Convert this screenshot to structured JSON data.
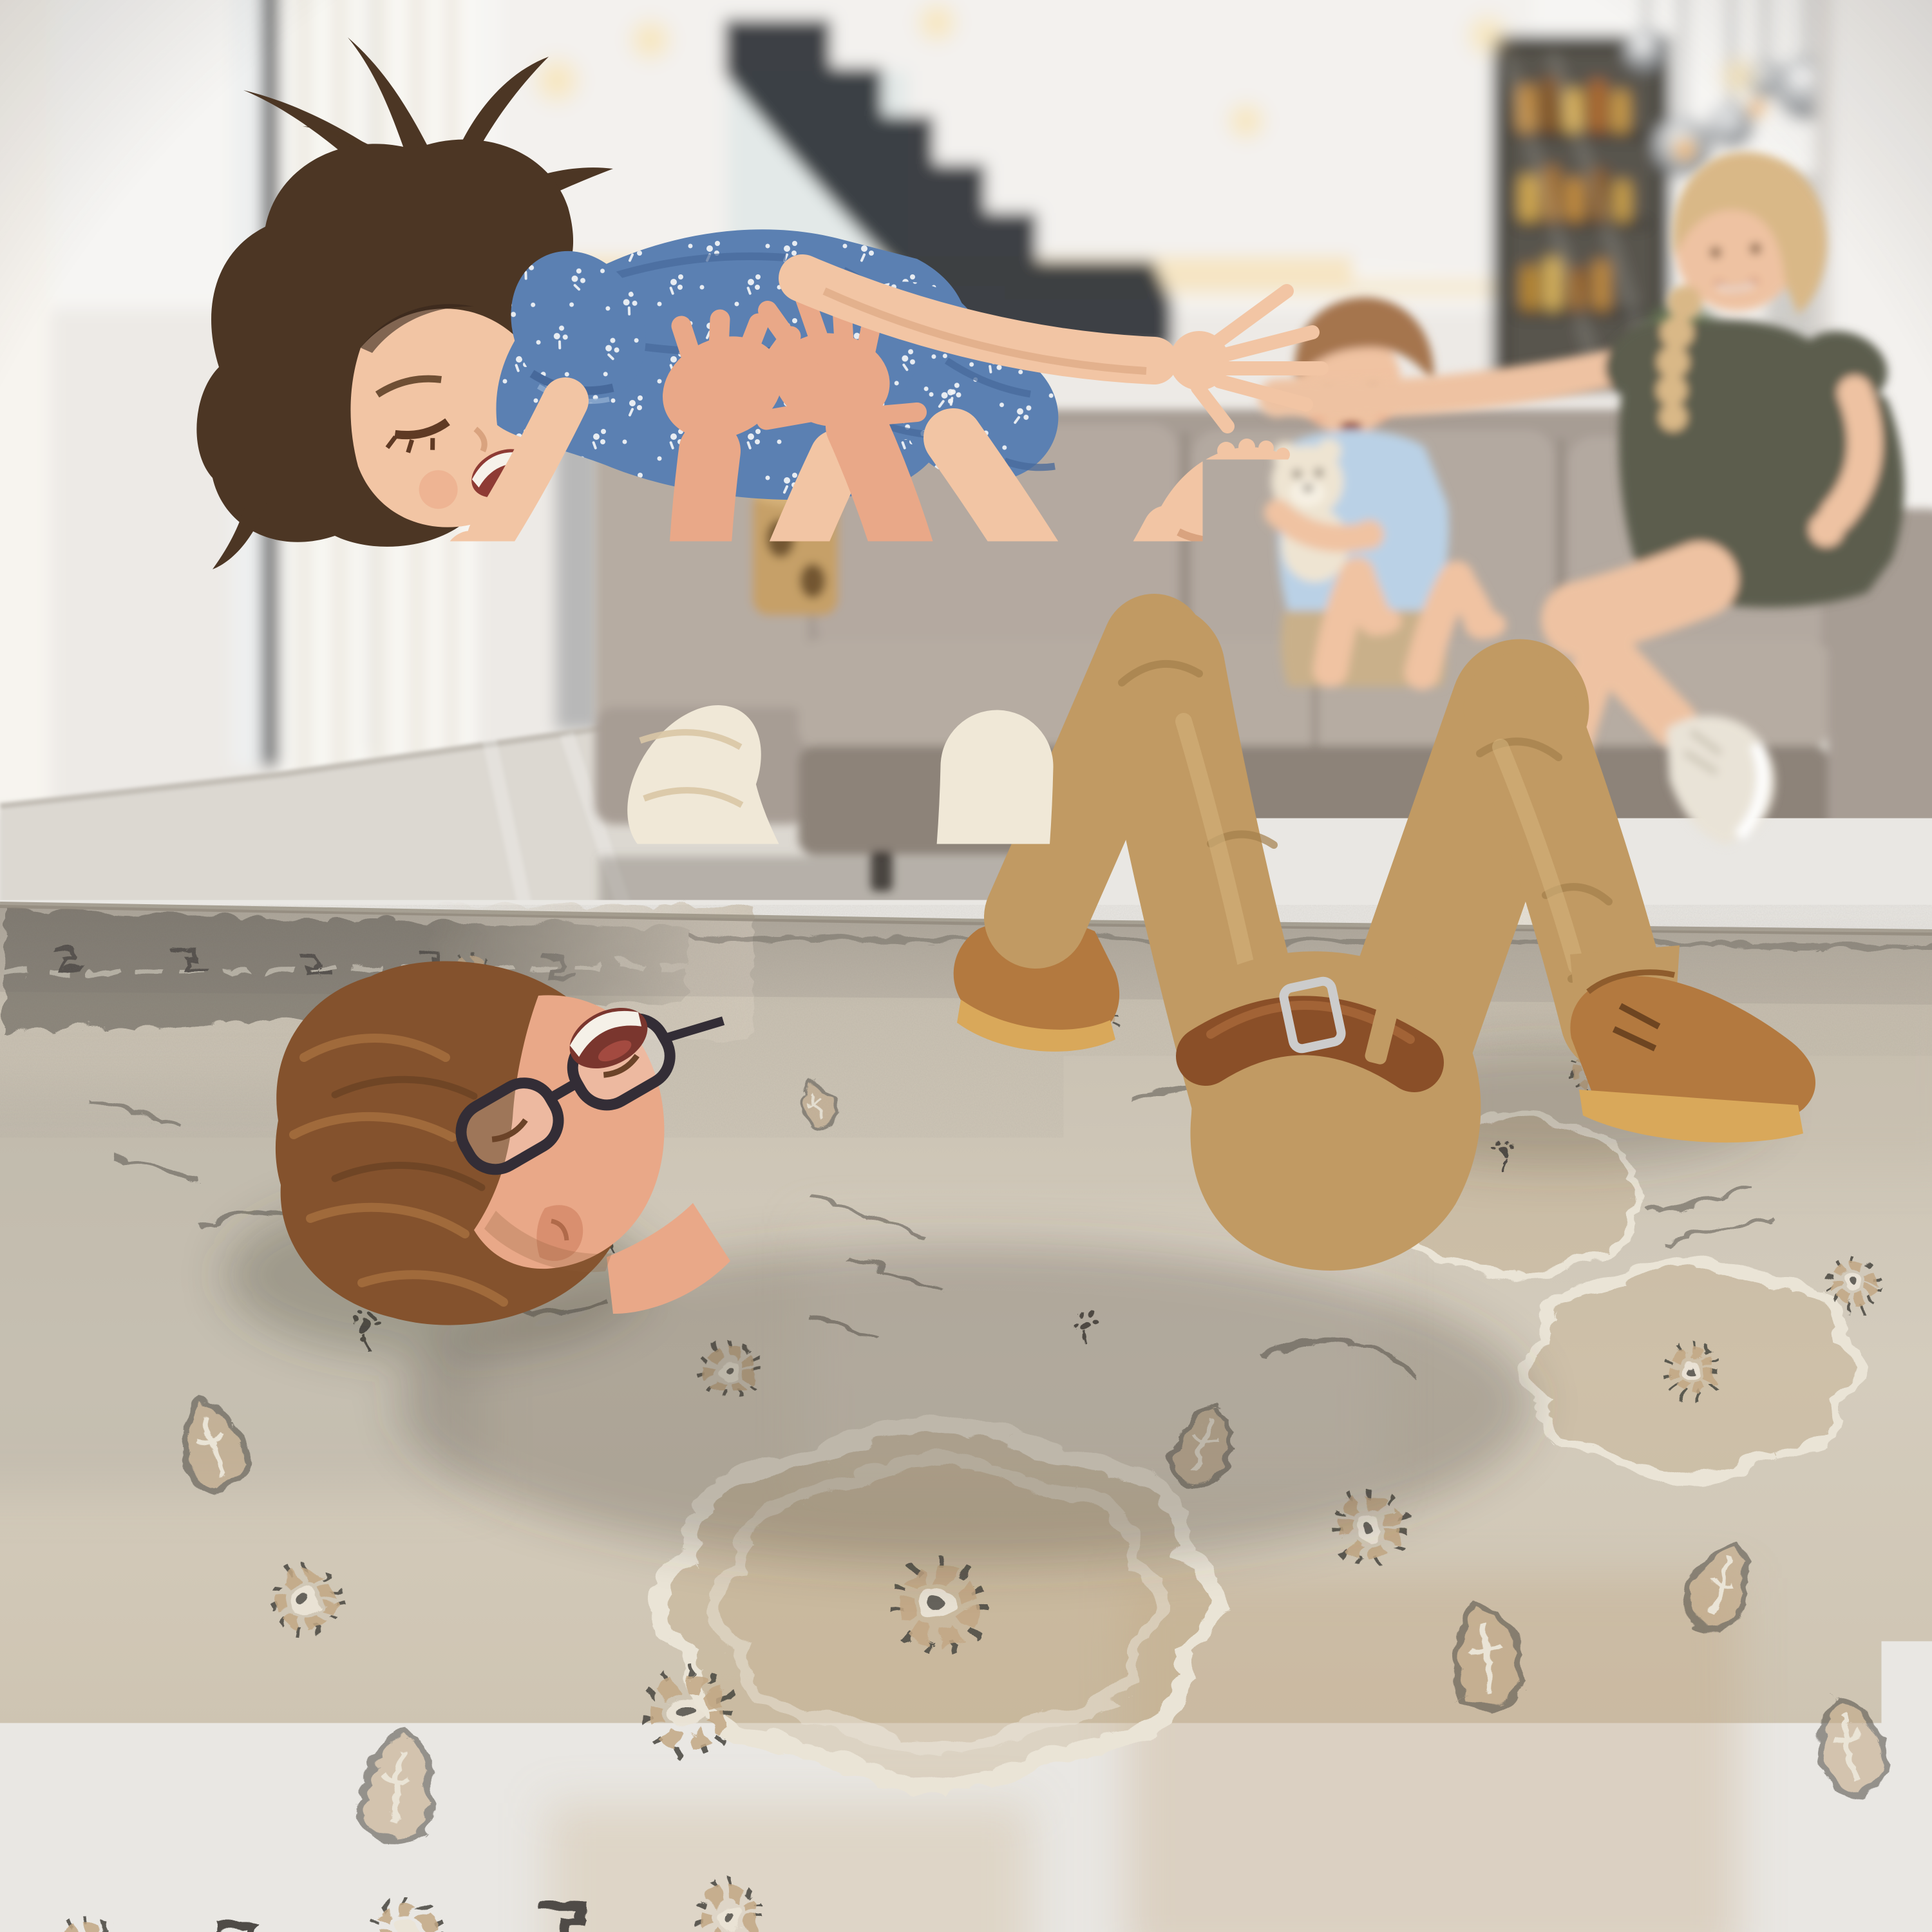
{
  "meta": {
    "type": "photograph",
    "description": "Bright modern open-plan living room. A father in a cream striped shirt and khaki chinos lies on his back on a large vintage-style beige and grey medallion rug, laughing as he lifts his young daughter overhead airplane-style; she wears a blue floral dress and laughs with her arms stretched wide. Behind them a blonde mother in an olive dress and a toddler boy hugging a cream teddy bear watch from a grey fabric sofa. Floor-to-ceiling windows with sheer curtains stand on the left, a dark floating staircase and a glass drinks cabinet sit in the background, and smoked-glass globe pendant lights hang at the right beside a white column.",
    "mood": "joyful family play",
    "setting": "living room"
  },
  "palette": {
    "wall": "#edeae6",
    "wallShade": "#e1ddd8",
    "ceiling": "#f6f5f3",
    "glow": "#f6ddae",
    "floor": "#dcd8d1",
    "floorShadow": "#b7b2ab",
    "windowFrame": "#3b3e42",
    "glass": "#eef0f0",
    "curtain": "#f7f4ef",
    "curtainBeige": "#eae2d5",
    "stair": "#2d3136",
    "column": "#f3f1ee",
    "cabinet": "#433f39",
    "bottleAmber": "#c08a3e",
    "pendant": "#85898d",
    "pendantGlow": "#f2b25e",
    "sofa": "#a79d94",
    "sofaLight": "#b6aca2",
    "sofaDark": "#8d8379",
    "sofaShadow": "#6d665f",
    "stool": "#c6a068",
    "skinGirl": "#f2c5a4",
    "skinGirlShade": "#d9a37f",
    "hairGirl": "#4c3624",
    "hairGirlHi": "#6f4f34",
    "skinDad": "#e9a888",
    "skinDadShade": "#c9805f",
    "hairDad": "#84522d",
    "hairDadHi": "#a8713f",
    "shirt": "#f0e8d7",
    "shirtStripe": "#d9c6a5",
    "khaki": "#c19a63",
    "khakiDark": "#a37f4c",
    "belt": "#8a4f28",
    "buckle": "#cccccc",
    "shoe": "#b3793f",
    "shoeSole": "#d9a85a",
    "denim": "#5b80b2",
    "denimDark": "#47699b",
    "floralWhite": "#f4f6f8",
    "skinMom": "#eec2a2",
    "hairMom": "#d9b887",
    "olive": "#5c5d4d",
    "sneaker": "#e9e3d7",
    "skinBoy": "#f0c3a2",
    "hairBoy": "#a5754e",
    "tee": "#bad1e6",
    "shortsBoy": "#c9b08a",
    "teddy": "#eee4d2",
    "rugBase": "#d2c9ba",
    "rugLight": "#e3ddcf",
    "rugTan": "#c2a784",
    "rugGray": "#a9a296",
    "rugCharcoal": "#4f4c46",
    "rugCream": "#eae4d6",
    "rugEdge": "#968e80",
    "shadow": "#4a443c"
  },
  "scene": {
    "people": {
      "father": {
        "pose": "lying on back on the rug, knees bent up, arms raised holding daughter overhead",
        "expression": "wide open laughing smile",
        "hair": "auburn-brown, wavy, spread on rug",
        "accessories": [
          "dark rectangular glasses"
        ],
        "clothing": [
          "cream pin-striped shirt with rolled sleeves",
          "khaki chino trousers",
          "brown leather belt",
          "tan suede desert boots with crepe soles"
        ]
      },
      "daughter": {
        "pose": "held horizontally overhead, back arched, arms spread like airplane wings, one bare foot kicked up",
        "expression": "laughing with eyes squeezed shut",
        "hair": "dark brown with high messy ponytail and chin-length front strands",
        "clothing": [
          "blue chambray dress with small white flower print",
          "matching bloomer shorts"
        ]
      },
      "mother": {
        "pose": "seated on right end of sofa, legs crossed, one arm stretched along the sofa back toward her son",
        "expression": "broad smile, watching the play",
        "hair": "blonde, pulled back with a side braid over her shoulder",
        "clothing": [
          "olive-green short-sleeve dress",
          "beige-white low-top sneakers"
        ]
      },
      "son": {
        "pose": "toddler sitting on the sofa, knees up, hugging a teddy bear",
        "expression": "smiling, watching",
        "hair": "light brown, short",
        "clothing": [
          "light blue t-shirt",
          "khaki shorts",
          "barefoot"
        ],
        "toy": "cream plush teddy bear"
      }
    },
    "furniture": {
      "sofa": "light grey-taupe fabric sofa with left chaise arm, loose back cushions and black feet",
      "side_stool": "tan cork stool with dark oval cut-outs, beside the chaise",
      "rug": {
        "style": "oversized vintage distressed oriental medallion rug",
        "colors": [
          "greige field",
          "cream medallion outlines",
          "tan abrash patches",
          "charcoal motif linework"
        ],
        "features": [
          "large lobed medallions",
          "dotted rosette flowers",
          "palmette leaves",
          "thin vine scrolls",
          "dark corner border at top-left",
          "geometric border band across the bottom"
        ]
      }
    },
    "architecture": {
      "left": [
        "floor-to-ceiling glazing with dark frames",
        "white sheer curtains",
        "beige curtain panel",
        "pale grey tiled floor"
      ],
      "center": [
        "white walls",
        "dark floating staircase, blurred",
        "warm LED cove light under ceiling soffit"
      ],
      "right": [
        "glass-front drinks cabinet with amber bottles",
        "small green plant",
        "white structural column",
        "cluster of smoked-glass globe pendant lights with warm filaments"
      ],
      "ceiling": [
        "recessed warm spotlights"
      ]
    },
    "depth_of_field": "background and sofa softly blurred; father, daughter and rug in sharp focus"
  }
}
